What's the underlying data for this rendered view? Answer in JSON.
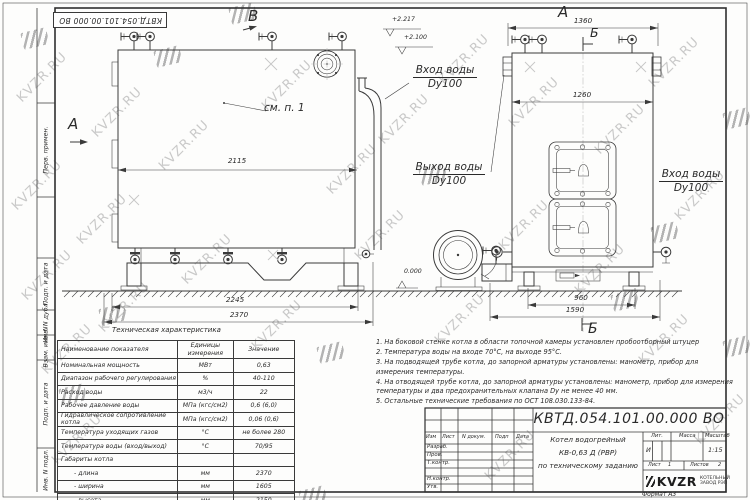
{
  "watermark": {
    "text": "KVZR.RU"
  },
  "corner_stamp": "КВТД.054.101.00.000 ВО",
  "margin_labels": {
    "perv": "Перв. примен.",
    "podp1": "Подп. и дата",
    "inv_dubl": "Инв. N дубл.",
    "vzam": "Взам. инв. N",
    "podp2": "Подп. и дата",
    "inv_podl": "Инв. N подл."
  },
  "side_view": {
    "view_letter": "В",
    "cut_letter": "А",
    "see_note": "см. п. 1",
    "dim_width": "2115",
    "dim_base": "2245",
    "dim_overall": "2370",
    "level_1": "+2.217",
    "level_2": "+2.100",
    "level_zero": "0.000",
    "inlet_line1": "Вход воды",
    "inlet_line2": "Dy100",
    "outlet_line1": "Выход воды",
    "outlet_line2": "Dy100"
  },
  "front_view": {
    "view_letter": "А",
    "section_top": "Б",
    "section_bottom": "Б",
    "dim_top": "1360",
    "dim_body": "1260",
    "dim_base": "960",
    "dim_overall": "1590",
    "inlet_line1": "Вход воды",
    "inlet_line2": "Dy100"
  },
  "notes": [
    "1. На боковой стенке котла в области топочной камеры установлен пробоотборный штуцер",
    "2. Температура воды на входе 70°С, на выходе 95°С.",
    "3. На подводящей трубе котла, до запорной арматуры установлены: манометр, прибор для измерения температуры.",
    "4. На отводящей трубе котла, до запорной арматуры установлены: манометр, прибор для измерения температуры и два предохранительных клапана Dу не менее 40 мм.",
    "5. Остальные технические требования по ОСТ 108.030.133-84."
  ],
  "tech_table": {
    "title": "Техническая характеристика",
    "col_name": "Наименование показателя",
    "col_unit": "Единицы измерения",
    "col_value": "Значение",
    "rows": [
      [
        "Номинальная мощность",
        "МВт",
        "0,63"
      ],
      [
        "Диапазон рабочего регулирования",
        "%",
        "40-110"
      ],
      [
        "Расход воды",
        "м3/ч",
        "22"
      ],
      [
        "Рабочее давление воды",
        "МПа (кгс/см2)",
        "0,6 (6,0)"
      ],
      [
        "Гидравлическое сопротивление котла",
        "МПа (кгс/см2)",
        "0,06 (0,6)"
      ],
      [
        "Температура уходящих газов",
        "°С",
        "не более 280"
      ],
      [
        "Температура воды (вход/выход)",
        "°С",
        "70/95"
      ],
      [
        "Габариты котла",
        "",
        ""
      ],
      [
        "- длина",
        "мм",
        "2370"
      ],
      [
        "- ширина",
        "мм",
        "1605"
      ],
      [
        "- высота",
        "мм",
        "2150"
      ]
    ]
  },
  "title_block": {
    "designation": "КВТД.054.101.00.000 ВО",
    "doc_name_line1": "Котел водогрейный",
    "doc_name_line2": "КВ-0,63 Д (РВР)",
    "doc_name_line3": "по техническому заданию",
    "hdr_izm": "Изм",
    "hdr_list": "Лист",
    "hdr_ndoc": "N докум.",
    "hdr_podp": "Подп",
    "hdr_data": "Дата",
    "row_razrab": "Разраб.",
    "row_prov": "Пров.",
    "row_tkontr": "Т.контр.",
    "row_nkontr": "Н.контр.",
    "row_utv": "Утв.",
    "lit_label": "Лит.",
    "mass_label": "Масса",
    "scale_label": "Масштаб",
    "lit_value": "И",
    "scale_value": "1:15",
    "sheet_label": "Лист",
    "sheet_value": "1",
    "sheets_label": "Листов",
    "sheets_value": "2",
    "company": "KVZR",
    "company_line1": "КОТЕЛЬНЫЙ",
    "company_line2": "ЗАВОД РЭП",
    "format_note": "Формат А3"
  }
}
